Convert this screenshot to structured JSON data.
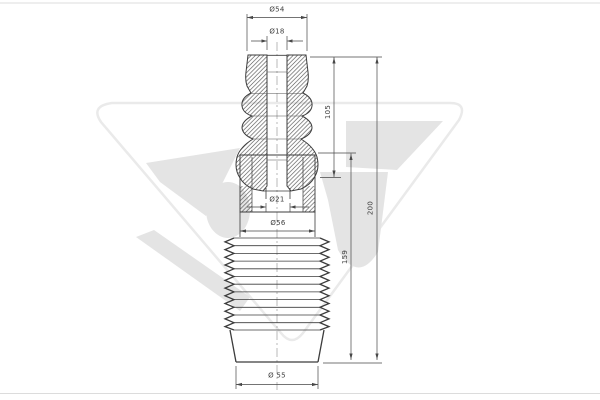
{
  "page": {
    "background": "#ffffff",
    "border_color": "#dcdcdc"
  },
  "watermark": {
    "logo": "hutchinson-triangle-logo",
    "outline_color": "#eaeaea",
    "fill_color": "#e4e4e4"
  },
  "drawing": {
    "subject": "strut-dust-cover-and-bump-stop-kit-cross-section",
    "line_color": "#3c3c3c",
    "dim_color": "#474747",
    "dimensions": {
      "top_width": "Ø54",
      "top_bore": "Ø18",
      "bump_stop_length": "105",
      "rod_bore": "Ø21",
      "boot_neck": "Ø56",
      "boot_length": "159",
      "overall_length": "200",
      "bottom_width": "Ø 55"
    }
  }
}
